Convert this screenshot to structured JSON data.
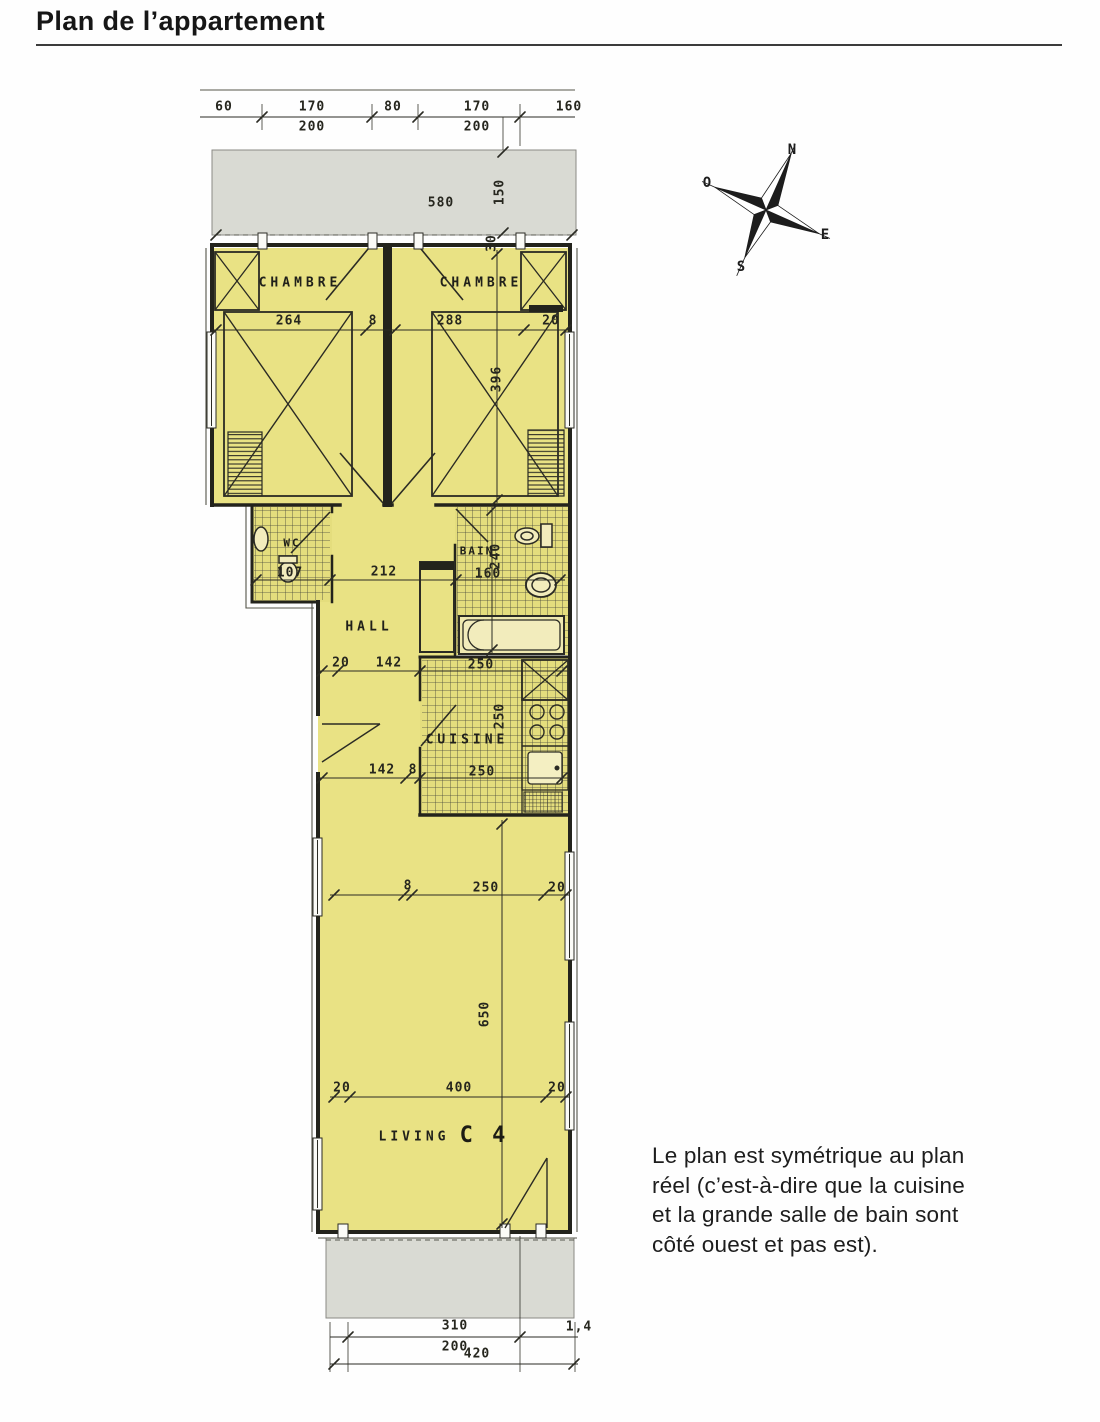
{
  "page": {
    "title": "Plan de l’appartement"
  },
  "caption": {
    "text": "Le plan est symétrique au plan réel (c’est-à-dire que la cuisine et la grande salle de bain sont côté ouest et pas est)."
  },
  "compass": {
    "icon": "compass-rose",
    "points": [
      {
        "t": "N",
        "x": 792,
        "y": 150
      },
      {
        "t": "O",
        "x": 707,
        "y": 183
      },
      {
        "t": "E",
        "x": 825,
        "y": 235
      },
      {
        "t": "S",
        "x": 741,
        "y": 267
      }
    ]
  },
  "plan": {
    "rooms": {
      "chambre_left": "CHAMBRE",
      "chambre_right": "CHAMBRE",
      "wc": "WC",
      "bain": "BAIN",
      "hall": "HALL",
      "cuisine": "CUISINE",
      "living": "LIVING",
      "unit": "C 4"
    },
    "dimensions": [
      {
        "t": "60",
        "x": 224,
        "y": 107
      },
      {
        "t": "170",
        "x": 312,
        "y": 107
      },
      {
        "t": "80",
        "x": 393,
        "y": 107
      },
      {
        "t": "170",
        "x": 477,
        "y": 107
      },
      {
        "t": "160",
        "x": 569,
        "y": 107
      },
      {
        "t": "200",
        "x": 312,
        "y": 127
      },
      {
        "t": "200",
        "x": 477,
        "y": 127
      },
      {
        "t": "580",
        "x": 441,
        "y": 203
      },
      {
        "t": "150",
        "x": 500,
        "y": 192,
        "r": 1
      },
      {
        "t": "30",
        "x": 492,
        "y": 243,
        "r": 1
      },
      {
        "t": "264",
        "x": 289,
        "y": 321
      },
      {
        "t": "8",
        "x": 373,
        "y": 321
      },
      {
        "t": "288",
        "x": 450,
        "y": 321
      },
      {
        "t": "20",
        "x": 551,
        "y": 321
      },
      {
        "t": "396",
        "x": 497,
        "y": 379,
        "r": 1
      },
      {
        "t": "107",
        "x": 290,
        "y": 573
      },
      {
        "t": "212",
        "x": 384,
        "y": 572
      },
      {
        "t": "160",
        "x": 488,
        "y": 574
      },
      {
        "t": "240",
        "x": 496,
        "y": 556,
        "r": 1
      },
      {
        "t": "20",
        "x": 341,
        "y": 663
      },
      {
        "t": "142",
        "x": 389,
        "y": 663
      },
      {
        "t": "250",
        "x": 481,
        "y": 665
      },
      {
        "t": "250",
        "x": 500,
        "y": 716,
        "r": 1
      },
      {
        "t": "142",
        "x": 382,
        "y": 770
      },
      {
        "t": "8",
        "x": 413,
        "y": 770
      },
      {
        "t": "250",
        "x": 482,
        "y": 772
      },
      {
        "t": "8",
        "x": 408,
        "y": 886
      },
      {
        "t": "250",
        "x": 486,
        "y": 888
      },
      {
        "t": "20",
        "x": 557,
        "y": 888
      },
      {
        "t": "650",
        "x": 485,
        "y": 1014,
        "r": 1
      },
      {
        "t": "20",
        "x": 342,
        "y": 1088
      },
      {
        "t": "400",
        "x": 459,
        "y": 1088
      },
      {
        "t": "20",
        "x": 557,
        "y": 1088
      },
      {
        "t": "310",
        "x": 455,
        "y": 1326
      },
      {
        "t": "200",
        "x": 455,
        "y": 1347
      },
      {
        "t": "420",
        "x": 477,
        "y": 1354
      },
      {
        "t": "1,4",
        "x": 579,
        "y": 1327
      }
    ]
  },
  "colors": {
    "room_yellow": "#e9e284",
    "tile_yellow": "#e4dd7d",
    "balcony_grey": "#d9dad3",
    "ink": "#26261e"
  }
}
